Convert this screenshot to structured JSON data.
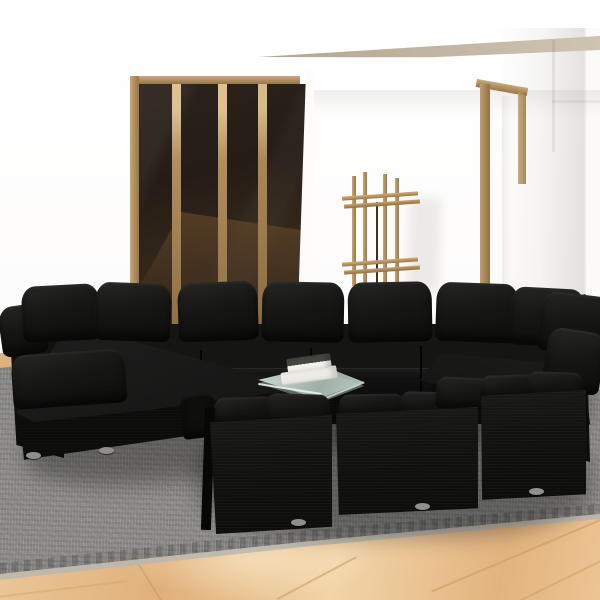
{
  "scene": {
    "type": "product-photo",
    "description": "Black poly-rattan outdoor lounge sofa set staged in a white room",
    "room": {
      "wall": "white walls with soft overhang soffit",
      "soffit_top": "tan angled ceiling edge at upper right",
      "glass_door": "dark tinted glass sliding door with wooden frame and two wooden mullions, upper left",
      "right_door_frame": "tall wooden door frame post, upper right",
      "coat_rack": "wooden clothes rack with four posts and double cross slats, center background",
      "floor": "beige marble tiles with diagonal seams",
      "rug": "large woven grey area rug placed diagonally"
    },
    "furniture": {
      "sofa": "U-shaped modular black rattan lounge set",
      "back_row_modules": 4,
      "front_row_modules": 3,
      "corner_modules": 2,
      "pillow_count_visible": 16,
      "feet": "small oval grey plastic feet under each module",
      "coffee_table": "low glass-top table inside the U",
      "books": "two white books stacked on the glass table, top one with dark cover"
    }
  },
  "colors": {
    "wall": "#fdfdfc",
    "wallShade": "#e9e5e0",
    "soffitTan": "#c4b6a2",
    "woodLight": "#c9a775",
    "woodDark": "#96754a",
    "glassDark": "#241c16",
    "glassWarm": "#46331f",
    "sofaBlack": "#121211",
    "pillowBlack": "#161615",
    "rugGrey": "#83827f",
    "rugBorder": "#68676420",
    "rugEdge": "#b9b7b0",
    "floorTan": "#e8bb85",
    "tileSeam": "#c89c68",
    "tableGlass": "#cdd9d1",
    "bookWhite": "#edebe5",
    "bookDark": "#474641",
    "feet": "#908f8b"
  }
}
